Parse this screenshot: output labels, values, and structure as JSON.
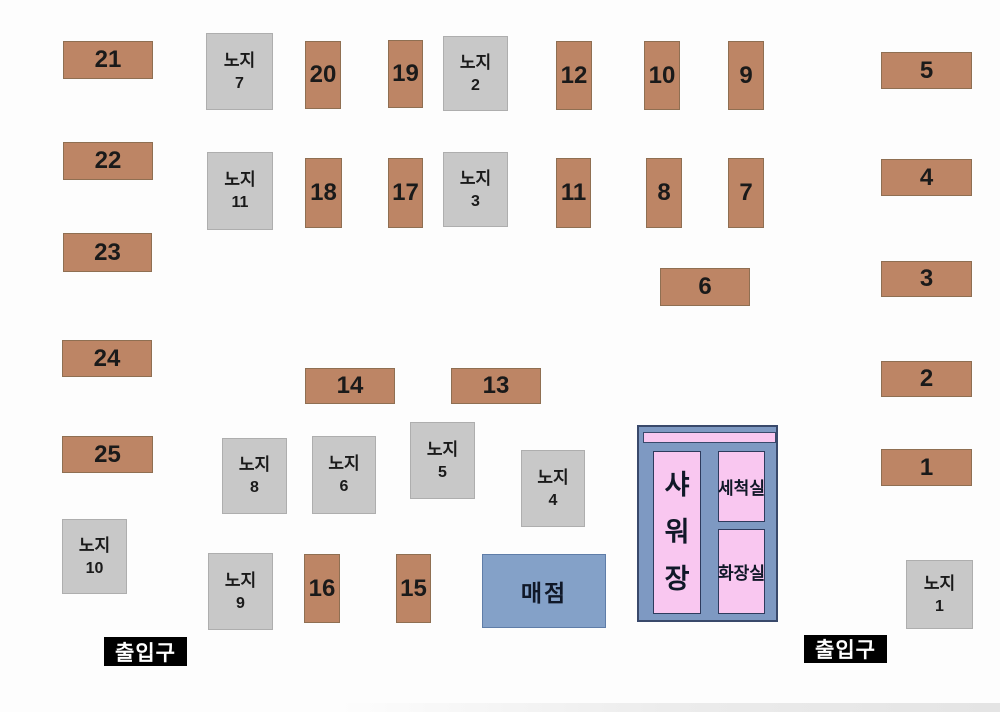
{
  "canvas": {
    "width": 1000,
    "height": 712,
    "background": "#fdfdfd"
  },
  "colors": {
    "site_fill": "#bd8565",
    "site_border": "#8f6f52",
    "open_fill": "#c8c8c8",
    "open_border": "#aeaeae",
    "store_fill": "#84a1c8",
    "facility_fill": "#7e99c2",
    "facility_border": "#39496b",
    "room_fill": "#f9c7f0",
    "room_border": "#2e3b5d",
    "entrance_bg": "#000000",
    "entrance_text": "#ffffff",
    "label_text": "#1a1a1a"
  },
  "sites": [
    {
      "label": "21",
      "x": 63,
      "y": 41,
      "w": 90,
      "h": 38
    },
    {
      "label": "20",
      "x": 305,
      "y": 41,
      "w": 36,
      "h": 68
    },
    {
      "label": "19",
      "x": 388,
      "y": 40,
      "w": 35,
      "h": 68
    },
    {
      "label": "12",
      "x": 556,
      "y": 41,
      "w": 36,
      "h": 69
    },
    {
      "label": "10",
      "x": 644,
      "y": 41,
      "w": 36,
      "h": 69
    },
    {
      "label": "9",
      "x": 728,
      "y": 41,
      "w": 36,
      "h": 69
    },
    {
      "label": "5",
      "x": 881,
      "y": 52,
      "w": 91,
      "h": 37
    },
    {
      "label": "22",
      "x": 63,
      "y": 142,
      "w": 90,
      "h": 38
    },
    {
      "label": "18",
      "x": 305,
      "y": 158,
      "w": 37,
      "h": 70
    },
    {
      "label": "17",
      "x": 388,
      "y": 158,
      "w": 35,
      "h": 70
    },
    {
      "label": "11",
      "x": 556,
      "y": 158,
      "w": 35,
      "h": 70
    },
    {
      "label": "8",
      "x": 646,
      "y": 158,
      "w": 36,
      "h": 70
    },
    {
      "label": "7",
      "x": 728,
      "y": 158,
      "w": 36,
      "h": 70
    },
    {
      "label": "4",
      "x": 881,
      "y": 159,
      "w": 91,
      "h": 37
    },
    {
      "label": "23",
      "x": 63,
      "y": 233,
      "w": 89,
      "h": 39
    },
    {
      "label": "6",
      "x": 660,
      "y": 268,
      "w": 90,
      "h": 38
    },
    {
      "label": "3",
      "x": 881,
      "y": 261,
      "w": 91,
      "h": 36
    },
    {
      "label": "24",
      "x": 62,
      "y": 340,
      "w": 90,
      "h": 37
    },
    {
      "label": "14",
      "x": 305,
      "y": 368,
      "w": 90,
      "h": 36
    },
    {
      "label": "13",
      "x": 451,
      "y": 368,
      "w": 90,
      "h": 36
    },
    {
      "label": "2",
      "x": 881,
      "y": 361,
      "w": 91,
      "h": 36
    },
    {
      "label": "25",
      "x": 62,
      "y": 436,
      "w": 91,
      "h": 37
    },
    {
      "label": "1",
      "x": 881,
      "y": 449,
      "w": 91,
      "h": 37
    },
    {
      "label": "16",
      "x": 304,
      "y": 554,
      "w": 36,
      "h": 69
    },
    {
      "label": "15",
      "x": 396,
      "y": 554,
      "w": 35,
      "h": 69
    }
  ],
  "open_sites": [
    {
      "line1": "노지",
      "line2": "7",
      "x": 206,
      "y": 33,
      "w": 67,
      "h": 77
    },
    {
      "line1": "노지",
      "line2": "2",
      "x": 443,
      "y": 36,
      "w": 65,
      "h": 75
    },
    {
      "line1": "노지",
      "line2": "11",
      "x": 207,
      "y": 152,
      "w": 66,
      "h": 78
    },
    {
      "line1": "노지",
      "line2": "3",
      "x": 443,
      "y": 152,
      "w": 65,
      "h": 75
    },
    {
      "line1": "노지",
      "line2": "8",
      "x": 222,
      "y": 438,
      "w": 65,
      "h": 76
    },
    {
      "line1": "노지",
      "line2": "6",
      "x": 312,
      "y": 436,
      "w": 64,
      "h": 78
    },
    {
      "line1": "노지",
      "line2": "5",
      "x": 410,
      "y": 422,
      "w": 65,
      "h": 77
    },
    {
      "line1": "노지",
      "line2": "4",
      "x": 521,
      "y": 450,
      "w": 64,
      "h": 77
    },
    {
      "line1": "노지",
      "line2": "10",
      "x": 62,
      "y": 519,
      "w": 65,
      "h": 75
    },
    {
      "line1": "노지",
      "line2": "9",
      "x": 208,
      "y": 553,
      "w": 65,
      "h": 77
    },
    {
      "line1": "노지",
      "line2": "1",
      "x": 906,
      "y": 560,
      "w": 67,
      "h": 69
    }
  ],
  "store": {
    "label": "매점",
    "x": 482,
    "y": 554,
    "w": 124,
    "h": 74
  },
  "facility": {
    "x": 637,
    "y": 425,
    "w": 141,
    "h": 197,
    "top_bar": {
      "x": 4,
      "y": 5,
      "w": 133,
      "h": 11
    },
    "rooms": [
      {
        "label": "샤워장",
        "vertical": true,
        "x": 14,
        "y": 24,
        "w": 48,
        "h": 163
      },
      {
        "label": "세척실",
        "vertical": false,
        "x": 79,
        "y": 24,
        "w": 47,
        "h": 71
      },
      {
        "label": "화장실",
        "vertical": false,
        "x": 79,
        "y": 102,
        "w": 47,
        "h": 85
      }
    ]
  },
  "entrances": [
    {
      "label": "출입구",
      "x": 104,
      "y": 637,
      "w": 83,
      "h": 29
    },
    {
      "label": "출입구",
      "x": 804,
      "y": 635,
      "w": 83,
      "h": 28
    }
  ]
}
